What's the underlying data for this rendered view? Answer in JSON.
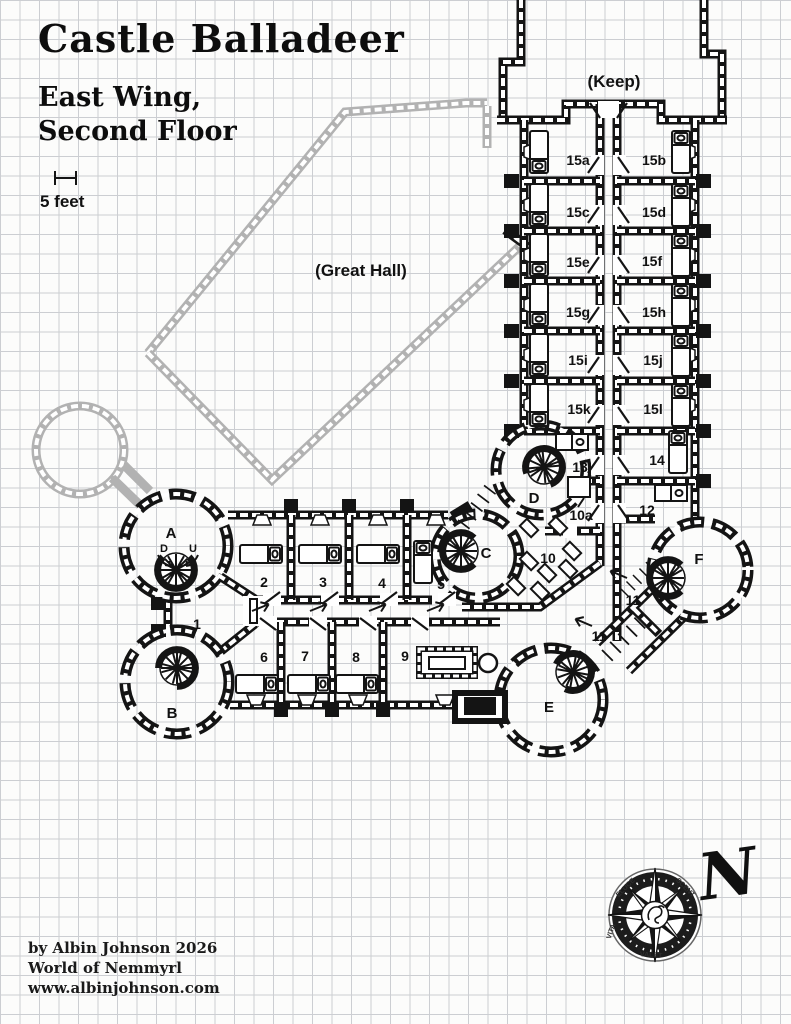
{
  "title": "Castle Balladeer",
  "subtitle_line1": "East Wing,",
  "subtitle_line2": "Second Floor",
  "scale": {
    "label": "5 feet"
  },
  "areas": {
    "keep": "(Keep)",
    "great_hall": "(Great Hall)"
  },
  "credits": {
    "line1": "by Albin Johnson 2026",
    "line2": "World of Nemmyrl",
    "line3": "www.albinjohnson.com"
  },
  "compass": {
    "north": "N",
    "ring_words": [
      {
        "label": "ELUCE",
        "x": 627,
        "y": 889,
        "rot": -45
      },
      {
        "label": "SCENT",
        "x": 684,
        "y": 889,
        "rot": 45
      },
      {
        "label": "VITA",
        "x": 613,
        "y": 932,
        "rot": -72
      },
      {
        "label": "VALET",
        "x": 651,
        "y": 957,
        "rot": 4
      }
    ]
  },
  "map": {
    "rooms": [
      {
        "label": "15a",
        "x": 578,
        "y": 165
      },
      {
        "label": "15b",
        "x": 654,
        "y": 165
      },
      {
        "label": "15c",
        "x": 578,
        "y": 217
      },
      {
        "label": "15d",
        "x": 654,
        "y": 217
      },
      {
        "label": "15e",
        "x": 578,
        "y": 267
      },
      {
        "label": "15f",
        "x": 652,
        "y": 266
      },
      {
        "label": "15g",
        "x": 578,
        "y": 317
      },
      {
        "label": "15h",
        "x": 654,
        "y": 317
      },
      {
        "label": "15i",
        "x": 578,
        "y": 365
      },
      {
        "label": "15j",
        "x": 653,
        "y": 365
      },
      {
        "label": "15k",
        "x": 579,
        "y": 414
      },
      {
        "label": "15l",
        "x": 653,
        "y": 414
      },
      {
        "label": "14",
        "x": 657,
        "y": 465
      },
      {
        "label": "13",
        "x": 580,
        "y": 472
      },
      {
        "label": "10a",
        "x": 581,
        "y": 520
      },
      {
        "label": "12",
        "x": 647,
        "y": 515
      },
      {
        "label": "10",
        "x": 548,
        "y": 563
      },
      {
        "label": "11",
        "x": 633,
        "y": 605
      },
      {
        "label": "11",
        "x": 599,
        "y": 641
      },
      {
        "label": "1",
        "x": 197,
        "y": 629
      },
      {
        "label": "2",
        "x": 264,
        "y": 587
      },
      {
        "label": "3",
        "x": 323,
        "y": 587
      },
      {
        "label": "4",
        "x": 382,
        "y": 588
      },
      {
        "label": "5",
        "x": 441,
        "y": 589
      },
      {
        "label": "6",
        "x": 264,
        "y": 662
      },
      {
        "label": "7",
        "x": 305,
        "y": 661
      },
      {
        "label": "8",
        "x": 356,
        "y": 662
      },
      {
        "label": "9",
        "x": 405,
        "y": 661
      }
    ],
    "towers": [
      {
        "label": "A",
        "x": 171,
        "y": 538
      },
      {
        "label": "B",
        "x": 172,
        "y": 718
      },
      {
        "label": "C",
        "x": 486,
        "y": 558
      },
      {
        "label": "D",
        "x": 534,
        "y": 503
      },
      {
        "label": "E",
        "x": 549,
        "y": 712
      },
      {
        "label": "F",
        "x": 699,
        "y": 564
      }
    ],
    "stair_marks": [
      {
        "label": "D",
        "x": 164,
        "y": 552
      },
      {
        "label": "U",
        "x": 193,
        "y": 552
      }
    ]
  },
  "colors": {
    "wall": "#141414",
    "lower_floor_wall": "#b2b2b2",
    "grid": "#ccced2",
    "paper": "#fcfcfb"
  }
}
